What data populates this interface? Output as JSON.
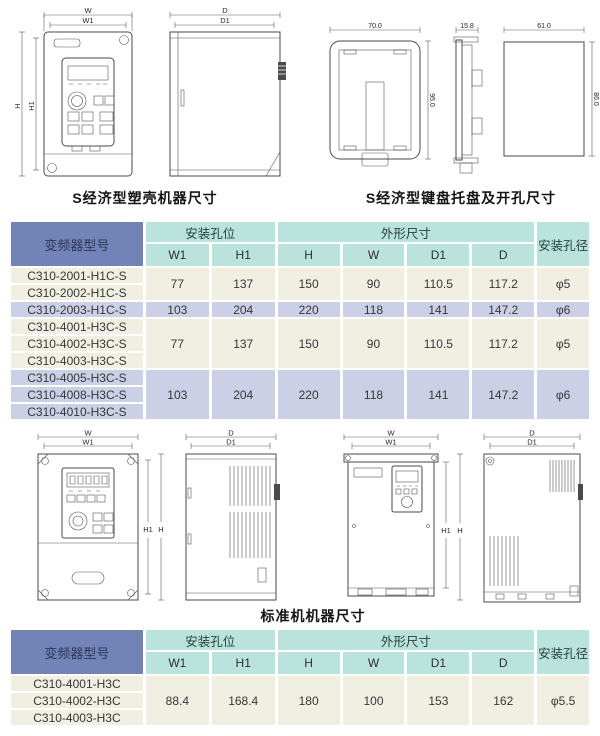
{
  "captions": {
    "s_case": "S经济型塑壳机器尺寸",
    "s_tray": "S经济型键盘托盘及开孔尺寸",
    "standard": "标准机机器尺寸"
  },
  "dims": {
    "w": "W",
    "w1": "W1",
    "h": "H",
    "h1": "H1",
    "d": "D",
    "d1": "D1",
    "tray_w": "70.0",
    "tray_h": "95.0",
    "tray_d": "15.8",
    "cut_w": "61.0",
    "cut_h": "86.0"
  },
  "colors": {
    "header_blue": "#7283b8",
    "header_teal": "#b9e3dc",
    "row_cream": "#f1efe2",
    "row_lavender": "#cbd0e7"
  },
  "table1": {
    "header": {
      "model": "变频器型号",
      "mount": "安装孔位",
      "outline": "外形尺寸",
      "hole": "安装孔径",
      "sub": [
        "W1",
        "H1",
        "H",
        "W",
        "D1",
        "D"
      ]
    },
    "groups": [
      {
        "models": [
          "C310-2001-H1C-S",
          "C310-2002-H1C-S"
        ],
        "values": [
          "77",
          "137",
          "150",
          "90",
          "110.5",
          "117.2",
          "φ5"
        ]
      },
      {
        "models": [
          "C310-2003-H1C-S"
        ],
        "values": [
          "103",
          "204",
          "220",
          "118",
          "141",
          "147.2",
          "φ6"
        ]
      },
      {
        "models": [
          "C310-4001-H3C-S",
          "C310-4002-H3C-S",
          "C310-4003-H3C-S"
        ],
        "values": [
          "77",
          "137",
          "150",
          "90",
          "110.5",
          "117.2",
          "φ5"
        ]
      },
      {
        "models": [
          "C310-4005-H3C-S",
          "C310-4008-H3C-S",
          "C310-4010-H3C-S"
        ],
        "values": [
          "103",
          "204",
          "220",
          "118",
          "141",
          "147.2",
          "φ6"
        ]
      }
    ]
  },
  "table2": {
    "header": {
      "model": "变频器型号",
      "mount": "安装孔位",
      "outline": "外形尺寸",
      "hole": "安装孔径",
      "sub": [
        "W1",
        "H1",
        "H",
        "W",
        "D1",
        "D"
      ]
    },
    "groups": [
      {
        "models": [
          "C310-4001-H3C",
          "C310-4002-H3C",
          "C310-4003-H3C"
        ],
        "values": [
          "88.4",
          "168.4",
          "180",
          "100",
          "153",
          "162",
          "φ5.5"
        ]
      }
    ]
  }
}
